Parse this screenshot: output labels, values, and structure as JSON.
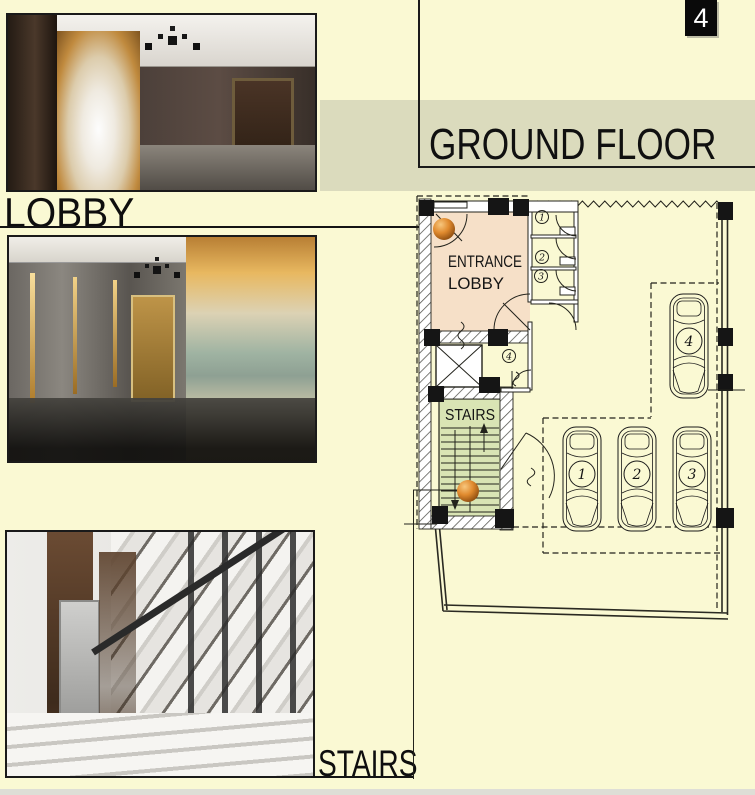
{
  "page": {
    "number_badge": "4",
    "title": "GROUND FLOOR"
  },
  "photo_labels": {
    "lobby": "LOBBY",
    "stairs": "STAIRS"
  },
  "plan": {
    "entrance_lobby": {
      "label": "ENTRANCE LOBBY",
      "line1": "ENTRANCE",
      "line2": "LOBBY"
    },
    "stairs_label": "STAIRS",
    "door_tags": [
      "1",
      "2",
      "3",
      "4"
    ],
    "parking_spots": [
      "1",
      "2",
      "3",
      "4"
    ]
  },
  "colors": {
    "background": "#FAF9D3",
    "band": "#DBDBBD",
    "entrance_fill": "#F6E0C8",
    "stairs_fill": "#D9E4B4",
    "marker_orange": "#DD7F1F",
    "line": "#1A1A1A"
  }
}
